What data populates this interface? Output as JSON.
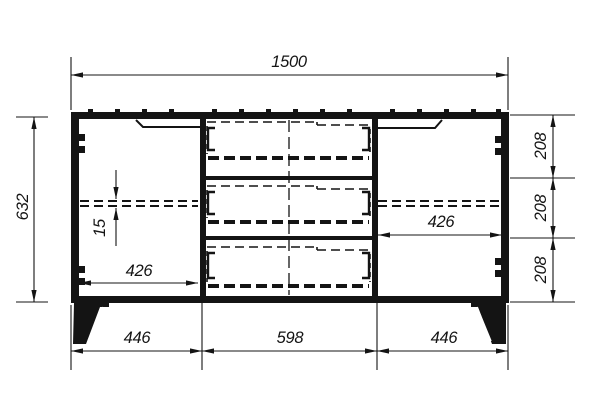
{
  "colors": {
    "line": "#141414",
    "background": "#ffffff"
  },
  "dims": {
    "width_total": "1500",
    "height_total": "632",
    "left_opening": "426",
    "right_opening": "426",
    "shelf_thickness": "15",
    "drawer_top": "208",
    "drawer_middle": "208",
    "drawer_bottom": "208",
    "base_left": "446",
    "base_mid": "598",
    "base_right": "446"
  }
}
